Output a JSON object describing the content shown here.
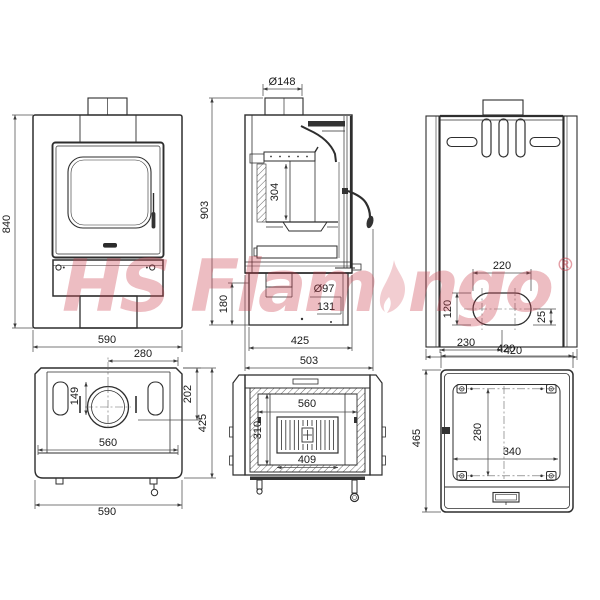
{
  "watermark": {
    "part1": "HS Flam",
    "part2": "ngo",
    "registered": "®",
    "color": "#cb3e4c"
  },
  "views": {
    "front": {
      "dims": {
        "height": "840",
        "width": "590"
      }
    },
    "side_section": {
      "dims": {
        "flue_diameter": "Ø148",
        "height": "903",
        "firebox_height": "304",
        "base_height": "180",
        "ash_hole_diameter": "Ø97",
        "ash_hole_offset": "131",
        "depth": "425",
        "overall_depth": "503"
      }
    },
    "back": {
      "dims": {
        "outlet_width": "220",
        "outlet_height": "120",
        "outlet_edge_offset": "25",
        "outlet_left_offset": "230",
        "width": "420"
      }
    },
    "top": {
      "dims": {
        "flue_center_offset": "280",
        "slot_length": "149",
        "flue_center_depth": "202",
        "depth": "425",
        "inner_width": "560",
        "width": "590"
      }
    },
    "firebox_section": {
      "dims": {
        "inner_width": "560",
        "inner_depth": "310",
        "grate_width": "409"
      }
    },
    "bottom": {
      "dims": {
        "width": "420",
        "depth": "465",
        "mount_spacing_depth": "280",
        "mount_spacing_width": "340"
      }
    }
  }
}
